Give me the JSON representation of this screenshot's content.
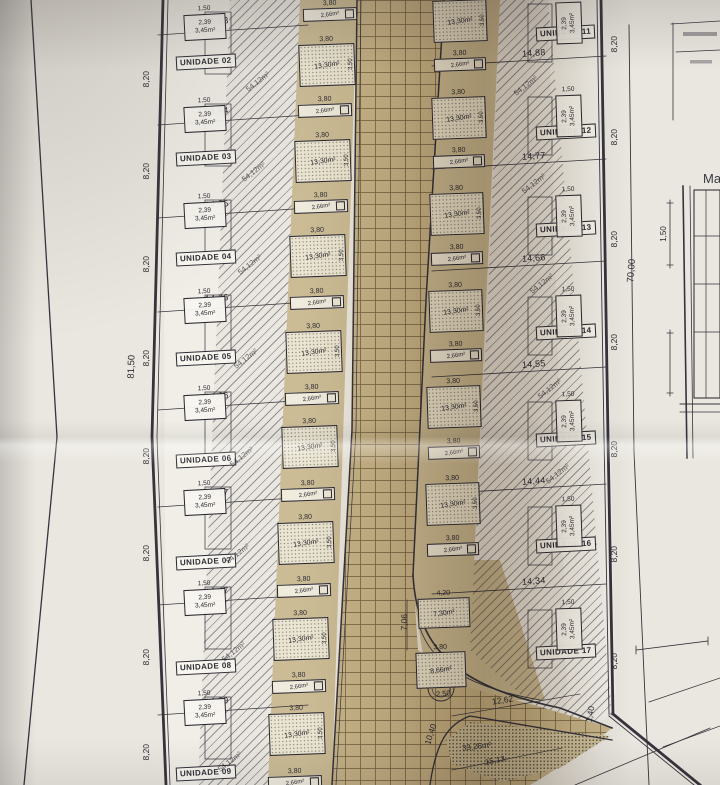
{
  "photo": {
    "paper_color": "#eae7e0",
    "road_color": "#c7b489",
    "ink_color": "#2e2b33",
    "description": "Fotografia de planta de implantação de loteamento"
  },
  "left_side": {
    "outer_length": "81,50",
    "segment": "8,20",
    "lot_area": "54,12m²",
    "unit_labels": [
      "UNIDADE 02",
      "UNIDADE 03",
      "UNIDADE 04",
      "UNIDADE 05",
      "UNIDADE 06",
      "UNIDADE 07",
      "UNIDADE 08",
      "UNIDADE 09"
    ],
    "front_dimensions": [
      "15,03",
      "14,94",
      "14,85",
      "14,76",
      "14,66",
      "14,37",
      "14,47",
      "14,39"
    ],
    "setback": {
      "width": "1,50",
      "depth": "2,39",
      "area": "3,45m²"
    }
  },
  "right_side": {
    "boundary_length": "70,00",
    "segment": "8,20",
    "corner_segment": "1,40",
    "lot_area": "54,12m²",
    "unit_labels": [
      "UNIDADE 11",
      "UNIDADE 12",
      "UNIDADE 13",
      "UNIDADE 14",
      "UNIDADE 15",
      "UNIDADE 16",
      "UNIDADE 17"
    ],
    "front_dimensions": [
      "14,88",
      "14,77",
      "14,66",
      "14,55",
      "14,44",
      "14,34"
    ],
    "setback": {
      "width": "1,50",
      "depth": "2,39",
      "area": "3,45m²"
    }
  },
  "street_units": {
    "covered_module": {
      "width": "3,80",
      "area": "13,30m²",
      "depth": "3,50"
    },
    "service_module": {
      "width": "3,80",
      "area": "2,66m²"
    }
  },
  "bottom": {
    "module_a": {
      "width": "4,20",
      "area": "7,30m²"
    },
    "module_b": {
      "width": "3,80",
      "area": "8,66m²",
      "radius": "2,50"
    },
    "depth": "7,06",
    "street_dim": "12,62",
    "curve_dim": "10,40",
    "green_area": "33,26m²",
    "edge_dim": "15,13"
  },
  "detail": {
    "window_height": "1,50",
    "edge_text": "Ma"
  }
}
